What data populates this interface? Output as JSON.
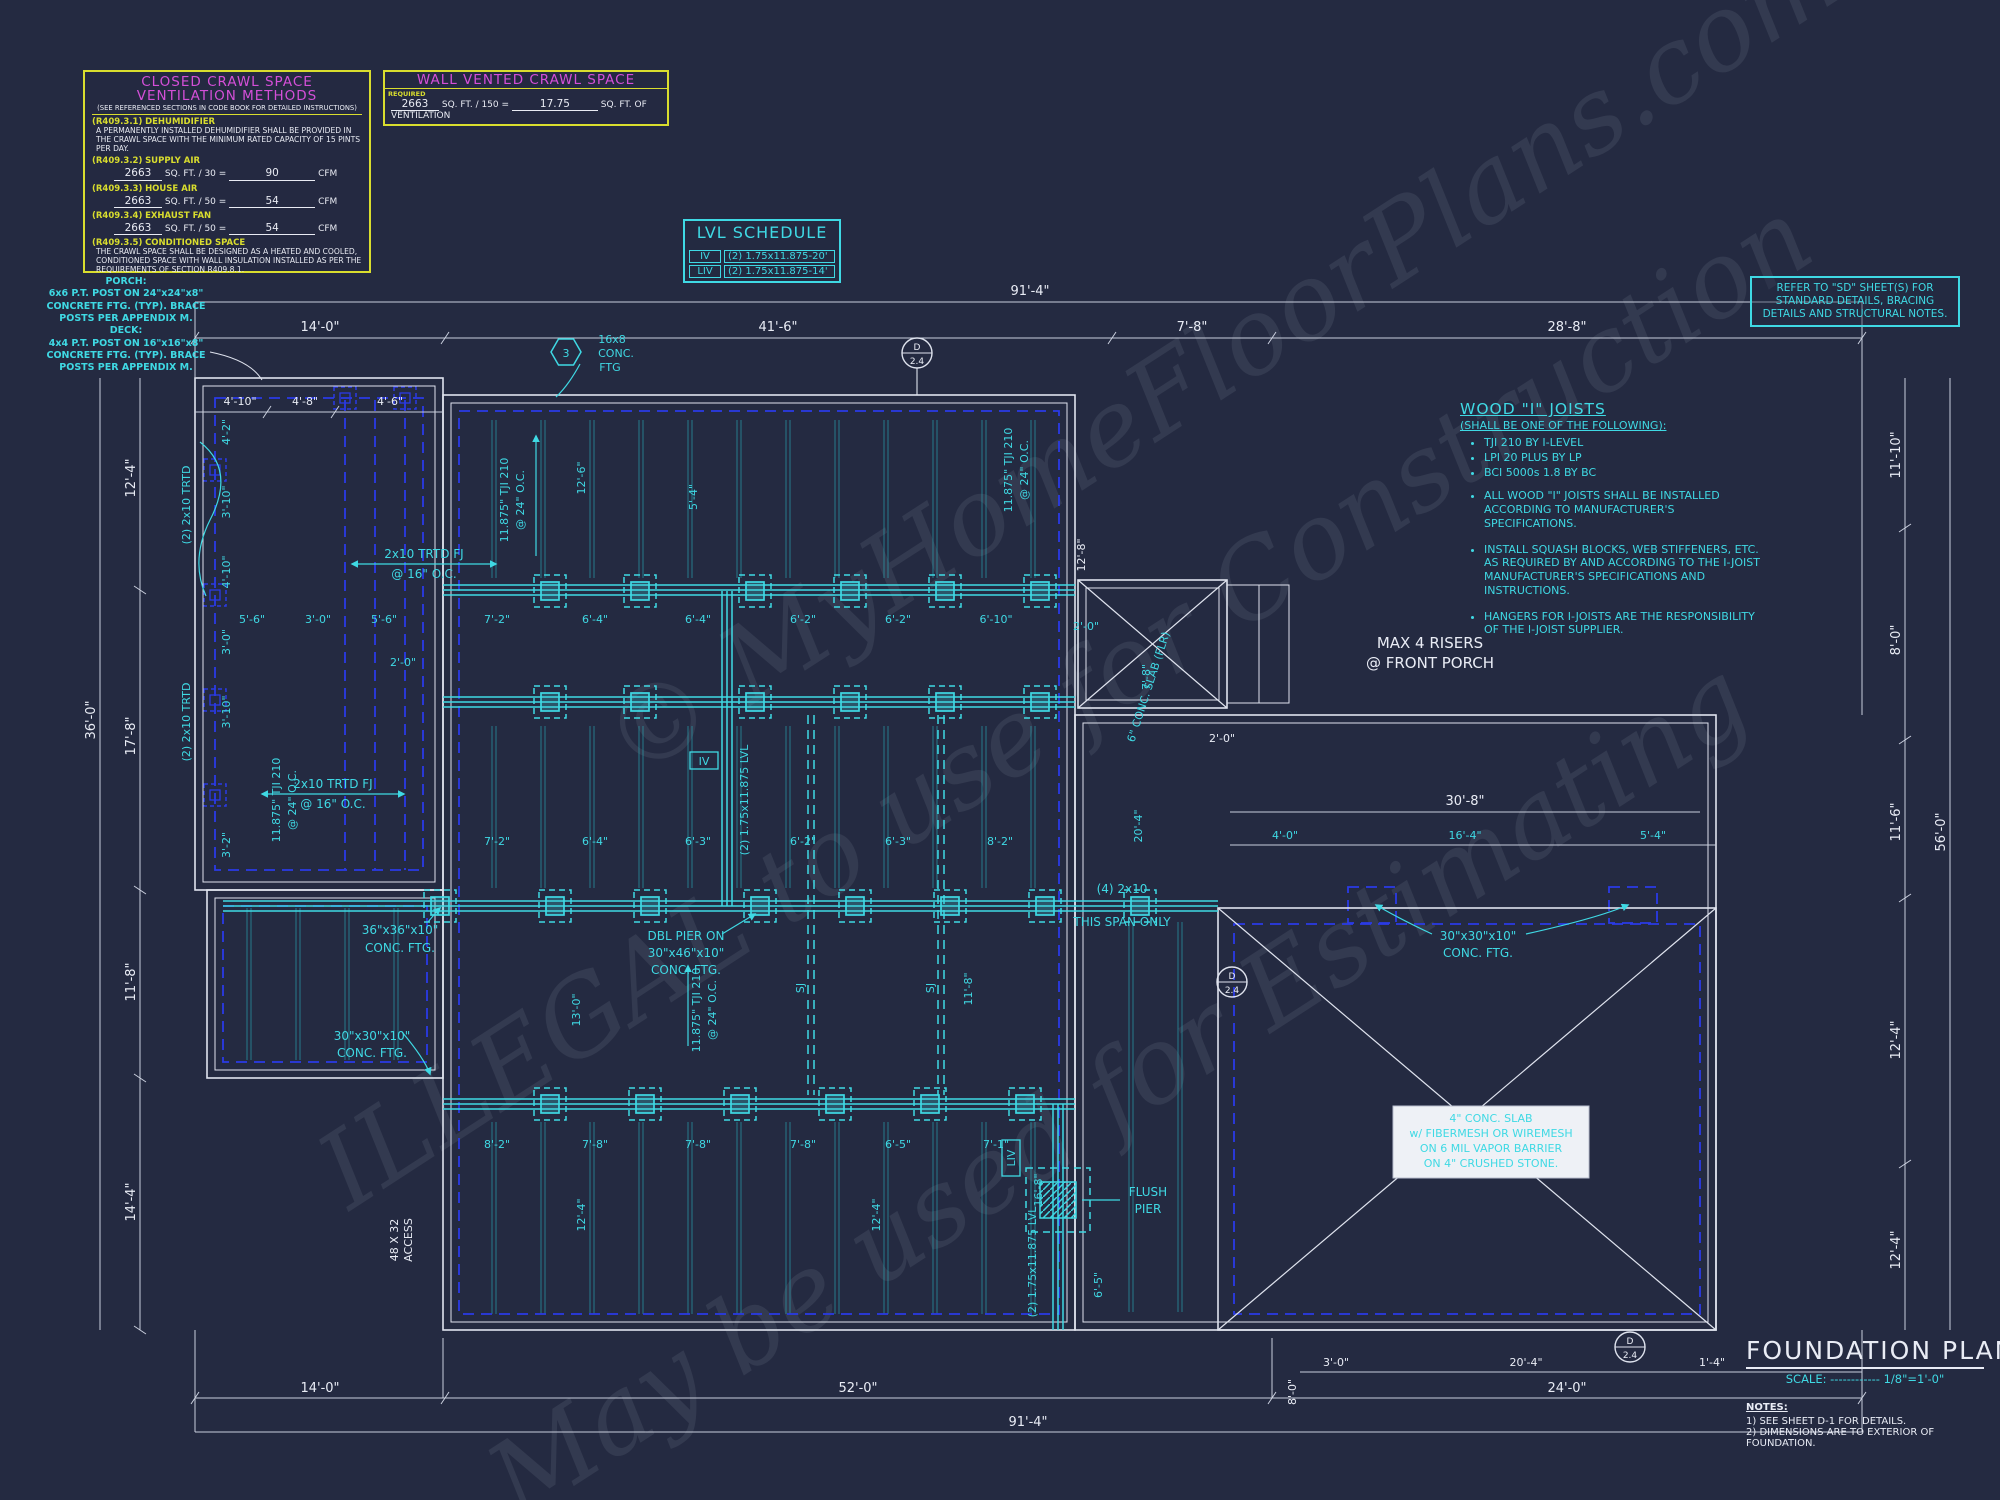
{
  "watermark": {
    "line1": "© MyHomeFloorPlans.com",
    "line2": "ILLEGAL to use for Construction",
    "line3": "May be used for Estimating"
  },
  "crawl_box": {
    "title1": "CLOSED CRAWL SPACE",
    "title2": "VENTILATION METHODS",
    "subtitle": "(SEE REFERENCED SECTIONS IN CODE BOOK FOR DETAILED INSTRUCTIONS)",
    "s1": {
      "code": "(R409.3.1)",
      "name": "DEHUMIDIFIER",
      "body": "A PERMANENTLY INSTALLED DEHUMIDIFIER SHALL BE PROVIDED IN THE CRAWL SPACE WITH THE MINIMUM RATED CAPACITY OF 15 PINTS PER DAY."
    },
    "s2": {
      "code": "(R409.3.2)",
      "name": "SUPPLY AIR",
      "area": "2663",
      "mid": "SQ. FT. / 30 =",
      "val": "90",
      "unit": "CFM"
    },
    "s3": {
      "code": "(R409.3.3)",
      "name": "HOUSE AIR",
      "area": "2663",
      "mid": "SQ. FT. / 50 =",
      "val": "54",
      "unit": "CFM"
    },
    "s4": {
      "code": "(R409.3.4)",
      "name": "EXHAUST FAN",
      "area": "2663",
      "mid": "SQ. FT. / 50 =",
      "val": "54",
      "unit": "CFM"
    },
    "s5": {
      "code": "(R409.3.5)",
      "name": "CONDITIONED SPACE",
      "body": "THE CRAWL SPACE SHALL BE DESIGNED AS A HEATED AND COOLED, CONDITIONED SPACE WITH WALL INSULATION INSTALLED AS PER THE REQUIREMENTS OF SECTION R409.8.1."
    }
  },
  "vented_box": {
    "title": "WALL VENTED CRAWL SPACE",
    "required": "REQUIRED",
    "area": "2663",
    "mid": "SQ. FT. / 150 =",
    "val": "17.75",
    "unit": "SQ. FT. OF VENTILATION"
  },
  "lvl_schedule": {
    "title": "LVL SCHEDULE",
    "rows": [
      {
        "mark": "IV",
        "desc": "(2) 1.75x11.875-20'"
      },
      {
        "mark": "LIV",
        "desc": "(2) 1.75x11.875-14'"
      }
    ]
  },
  "sd_note": {
    "text": "REFER TO \"SD\" SHEET(S) FOR STANDARD DETAILS, BRACING DETAILS AND STRUCTURAL NOTES."
  },
  "wood_joists": {
    "title": "WOOD \"I\" JOISTS",
    "subtitle": "(SHALL BE ONE OF THE FOLLOWING):",
    "options": [
      "TJI 210 BY I-LEVEL",
      "LPI 20 PLUS BY LP",
      "BCI 5000s 1.8 BY BC"
    ],
    "notes": [
      "ALL WOOD \"I\" JOISTS SHALL BE INSTALLED ACCORDING TO MANUFACTURER'S SPECIFICATIONS.",
      "INSTALL SQUASH BLOCKS, WEB STIFFENERS, ETC. AS REQUIRED BY AND ACCORDING TO THE I-JOIST MANUFACTURER'S SPECIFICATIONS AND INSTRUCTIONS.",
      "HANGERS FOR I-JOISTS ARE THE RESPONSIBILITY OF THE I-JOIST SUPPLIER."
    ]
  },
  "porch_note": {
    "title": "PORCH:",
    "l1": "6x6 P.T. POST ON 24\"x24\"x8\"",
    "l2": "CONCRETE FTG. (TYP). BRACE",
    "l3": "POSTS PER APPENDIX M."
  },
  "deck_note": {
    "title": "DECK:",
    "l1": "4x4 P.T. POST ON 16\"x16\"x8\"",
    "l2": "CONCRETE FTG. (TYP). BRACE",
    "l3": "POSTS PER APPENDIX M."
  },
  "max_risers": {
    "l1": "MAX 4 RISERS",
    "l2": "@ FRONT PORCH"
  },
  "slab_note": {
    "l1": "4\" CONC. SLAB",
    "l2": "w/ FIBERMESH OR WIREMESH",
    "l3": "ON 6 MIL VAPOR BARRIER",
    "l4": "ON 4\" CRUSHED STONE."
  },
  "title_block": {
    "title": "FOUNDATION PLAN",
    "scale_label": "SCALE:",
    "scale_dots": "------------",
    "scale_val": "1/8\"=1'-0\"",
    "notes_title": "NOTES:",
    "note1": "1)  SEE SHEET D-1 FOR DETAILS.",
    "note2": "2)  DIMENSIONS ARE TO EXTERIOR OF FOUNDATION."
  },
  "labels": {
    "fj1": "2x10 TRTD FJ",
    "fj2": "@ 16\" O.C.",
    "trtd_vert": "(2) 2x10 TRTD",
    "tji1": "11.875\" TJI 210",
    "tji2": "@ 24\" O.C.",
    "conc168_1": "16x8",
    "conc168_2": "CONC.",
    "conc168_3": "FTG",
    "ftg3636_1": "36\"x36\"x10\"",
    "ftg3636_2": "CONC. FTG.",
    "dbl1": "DBL PIER ON",
    "dbl2": "30\"x46\"x10\"",
    "dbl3": "CONC. FTG.",
    "ftg3030_1": "30\"x30\"x10\"",
    "ftg3030_2": "CONC. FTG.",
    "span1": "(4) 2x10",
    "span2": "THIS SPAN ONLY",
    "flush1": "FLUSH",
    "flush2": "PIER",
    "lvl_v": "(2) 1.75x11.875 LVL",
    "mark_iv": "IV",
    "mark_liv": "LIV",
    "slab6": "6\" CONC. SLAB (FLR)",
    "access1": "48 X 32",
    "access2": "ACCESS",
    "sj": "SJ",
    "callout_hex": "3",
    "callout_d": "D",
    "callout_n": "2.4"
  },
  "dims": {
    "top_overall": "91'-4\"",
    "top": [
      "14'-0\"",
      "41'-6\"",
      "7'-8\"",
      "28'-8\""
    ],
    "top_left": [
      "4'-10\"",
      "4'-8\"",
      "4'-6\""
    ],
    "left_outer": "36'-0\"",
    "left": [
      "12'-4\"",
      "17'-8\"",
      "11'-8\"",
      "14'-4\""
    ],
    "left_inner": [
      "4'-2\"",
      "3'-10\"",
      "4'-10\"",
      "3'-0\"",
      "3'-10\"",
      "3'-2\""
    ],
    "right_outer": "56'-0\"",
    "right": [
      "11'-10\"",
      "8'-0\"",
      "11'-6\"",
      "12'-4\"",
      "12'-4\""
    ],
    "bottom": [
      "14'-0\"",
      "52'-0\"",
      "24'-0\""
    ],
    "bottom_overall": "91'-4\"",
    "bottom_small": [
      "8'-0\"",
      "3'-0\"",
      "20'-4\"",
      "1'-4\""
    ],
    "beam1_left": [
      "5'-6\"",
      "3'-0\"",
      "5'-6\""
    ],
    "beam1": [
      "7'-2\"",
      "6'-4\"",
      "6'-4\"",
      "6'-2\"",
      "6'-2\"",
      "6'-10\""
    ],
    "beam2": [
      "7'-2\"",
      "6'-4\"",
      "6'-3\"",
      "6'-2\"",
      "6'-3\"",
      "8'-2\""
    ],
    "beam3": [
      "8'-2\"",
      "7'-8\"",
      "7'-8\"",
      "7'-8\"",
      "6'-5\"",
      "7'-1\""
    ],
    "right_mid": [
      "30'-8\"",
      "4'-0\"",
      "16'-4\"",
      "5'-4\""
    ],
    "verts": [
      "12'-6\"",
      "5'-4\"",
      "12'-8\"",
      "20'-4\"",
      "13'-0\"",
      "12'-4\"",
      "12'-4\"",
      "16'-8\"",
      "11'-8\"",
      "6'-5\""
    ],
    "two_zero": "2'-0\"",
    "seven_eight": "7'-8\""
  }
}
